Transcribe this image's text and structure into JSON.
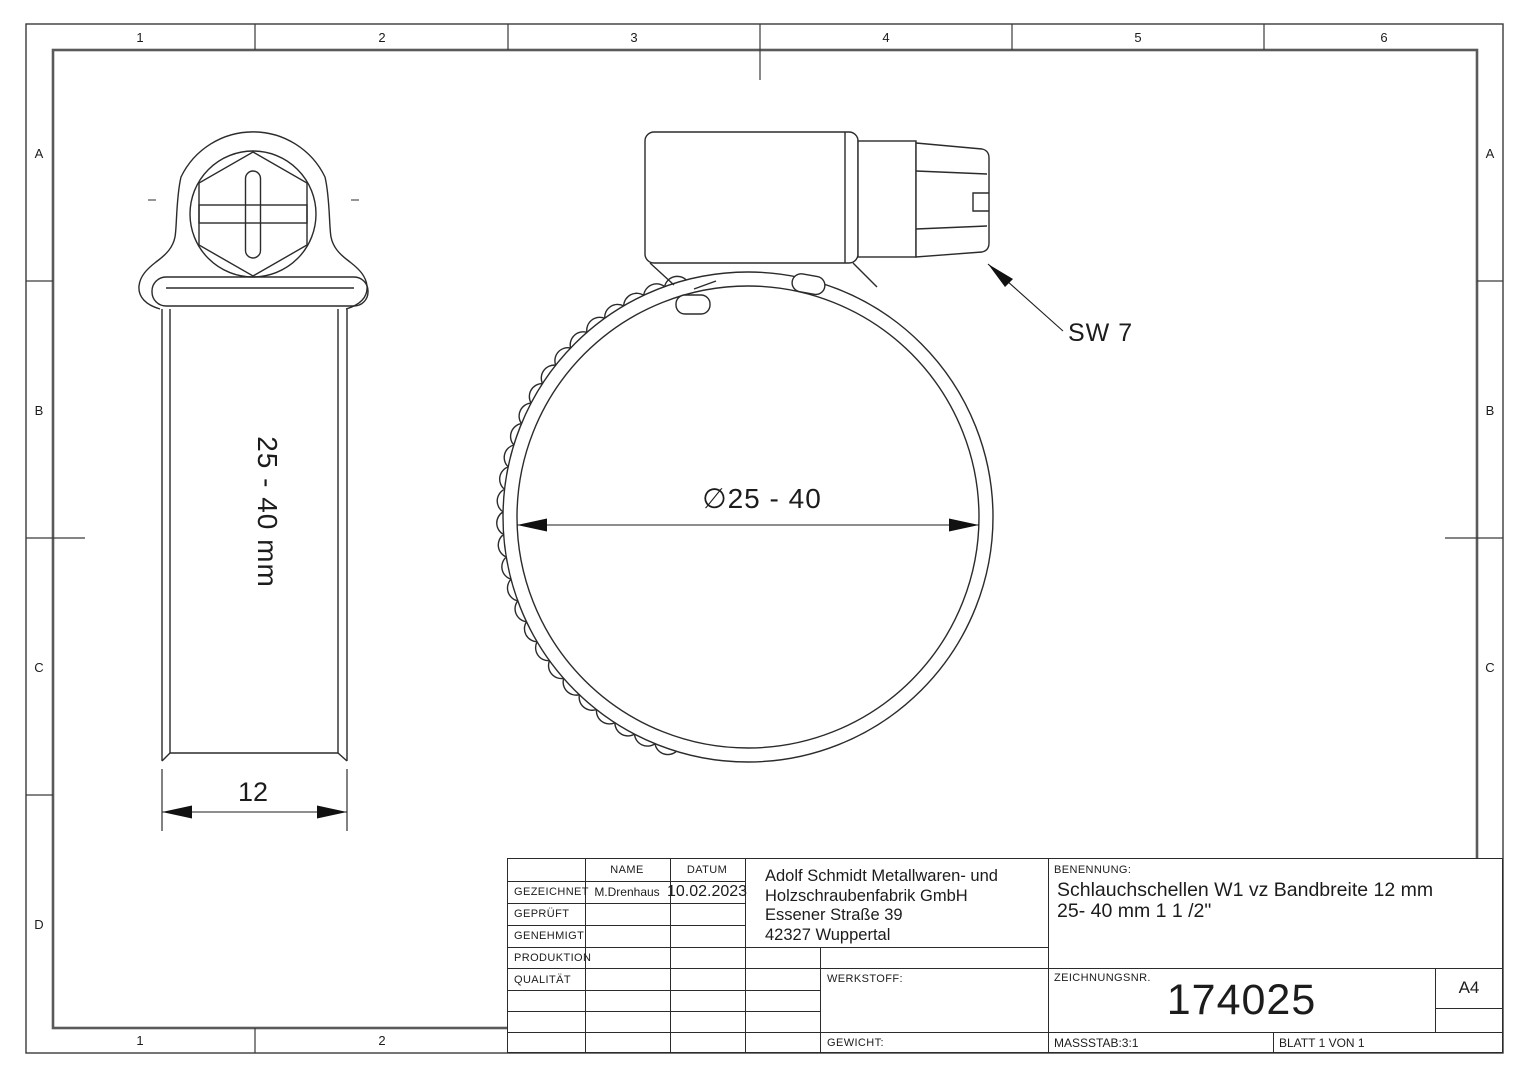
{
  "sheet": {
    "border_columns": [
      "1",
      "2",
      "3",
      "4",
      "5",
      "6"
    ],
    "border_rows": [
      "A",
      "B",
      "C",
      "D"
    ],
    "bottom_columns": [
      "1",
      "2"
    ]
  },
  "views": {
    "side_view": {
      "band_label": "25 - 40 mm",
      "width_dim": "12"
    },
    "front_view": {
      "diameter_dim": "∅25 - 40",
      "hex_label": "SW 7"
    }
  },
  "title_block": {
    "col_headers": {
      "name": "NAME",
      "date": "DATUM"
    },
    "rows": [
      {
        "label": "GEZEICHNET",
        "name": "M.Drenhaus",
        "date": "10.02.2023"
      },
      {
        "label": "GEPRÜFT",
        "name": "",
        "date": ""
      },
      {
        "label": "GENEHMIGT",
        "name": "",
        "date": ""
      },
      {
        "label": "PRODUKTION",
        "name": "",
        "date": ""
      },
      {
        "label": "QUALITÄT",
        "name": "",
        "date": ""
      }
    ],
    "company": "Adolf Schmidt Metallwaren- und\nHolzschraubenfabrik GmbH\nEssener Straße 39\n42327 Wuppertal",
    "benennung_label": "BENENNUNG:",
    "benennung_line1": "Schlauchschellen W1 vz Bandbreite 12 mm",
    "benennung_line2": "25- 40 mm 1 1 /2\"",
    "werkstoff_label": "WERKSTOFF:",
    "gewicht_label": "GEWICHT:",
    "zeichnungsnr_label": "ZEICHNUNGSNR.",
    "zeichnungsnr": "174025",
    "format": "A4",
    "massstab": "MASSSTAB:3:1",
    "blatt": "BLATT 1 VON 1"
  },
  "colors": {
    "line": "#2b2b2b",
    "paper": "#ffffff"
  }
}
